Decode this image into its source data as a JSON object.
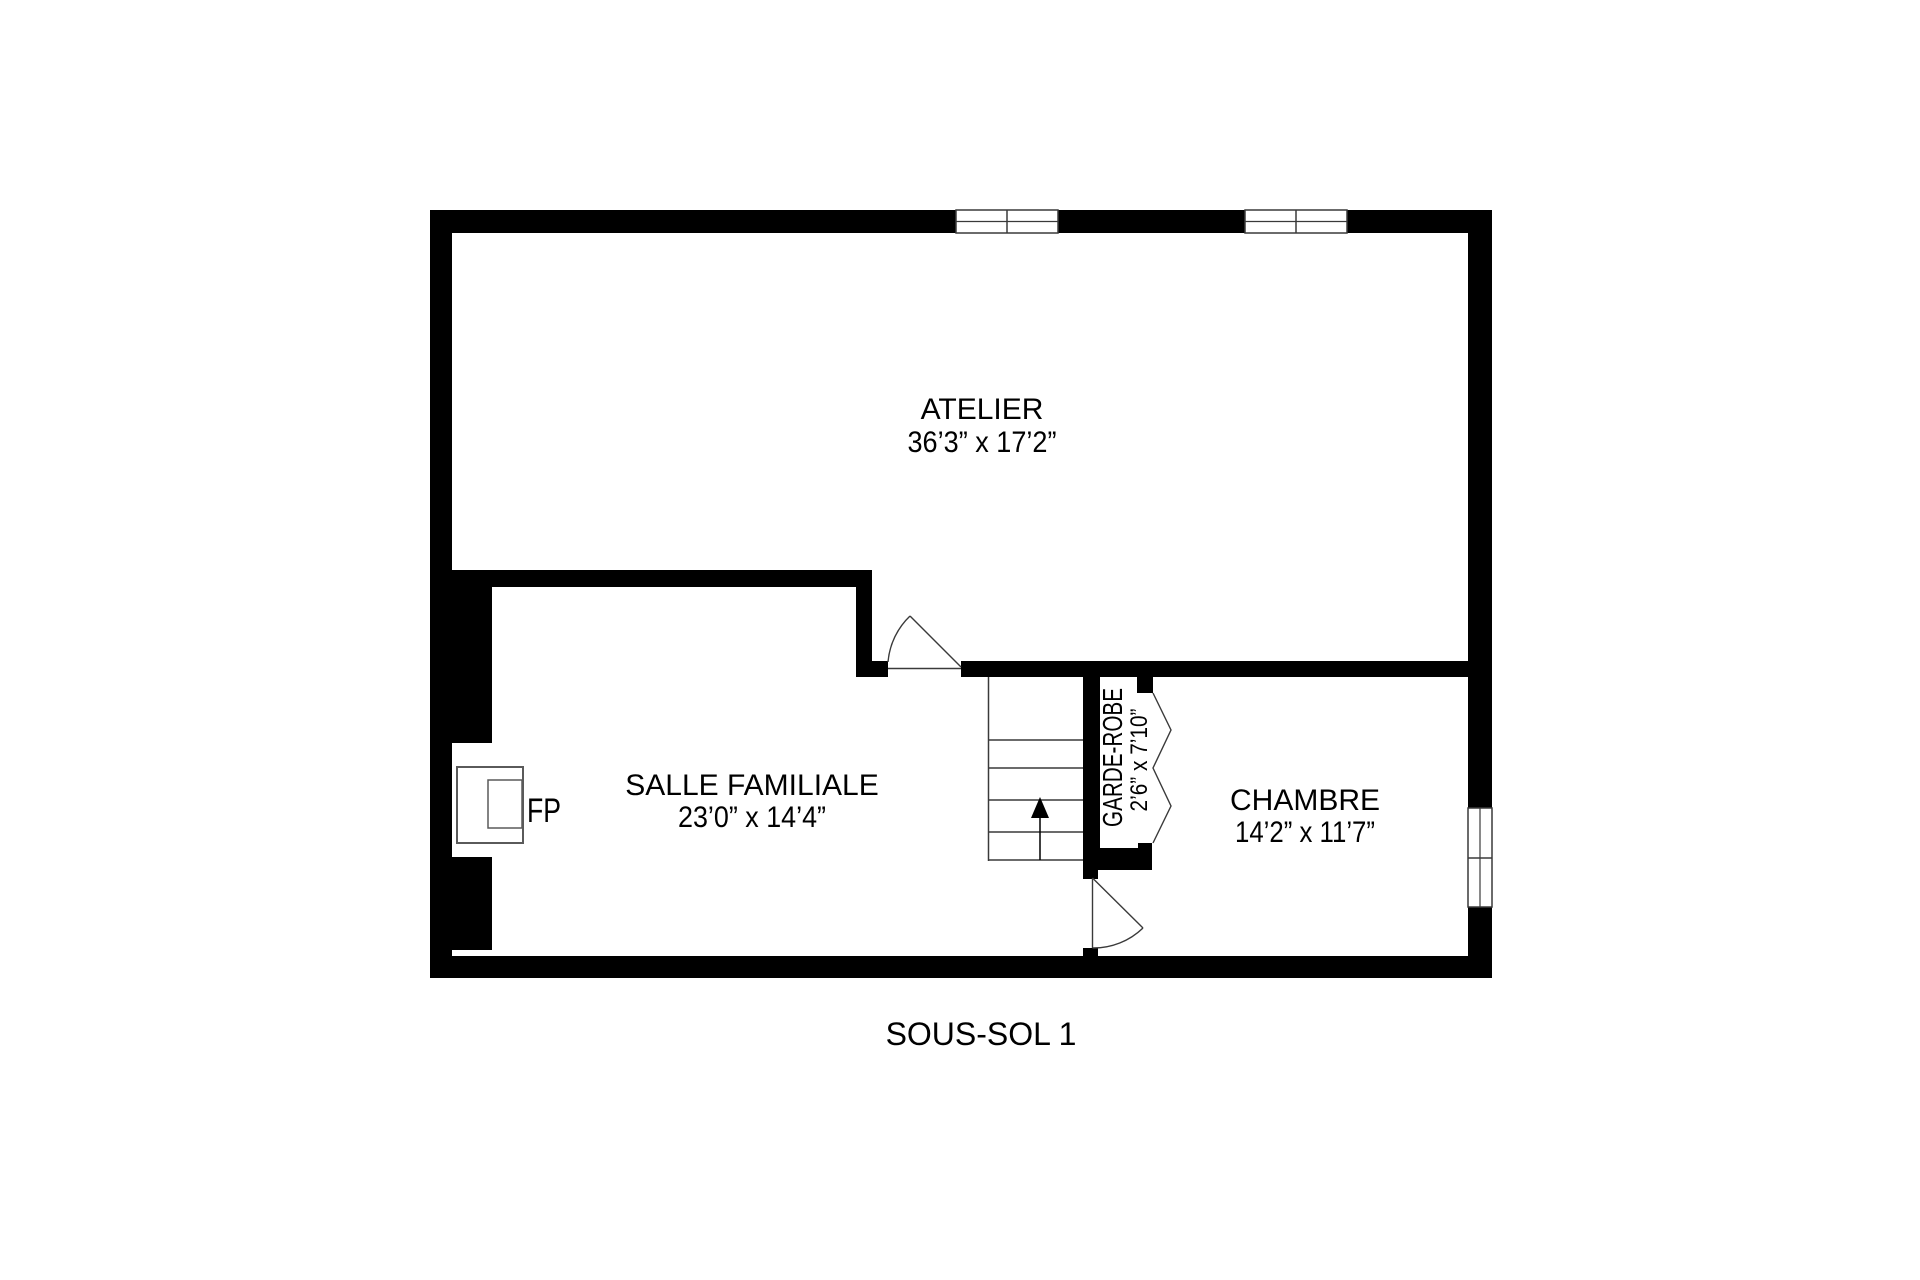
{
  "title": "SOUS-SOL 1",
  "rooms": {
    "atelier": {
      "name": "ATELIER",
      "dims": "36’3” x 17’2”"
    },
    "salle_familiale": {
      "name": "SALLE FAMILIALE",
      "dims": "23’0” x 14’4”"
    },
    "chambre": {
      "name": "CHAMBRE",
      "dims": "14’2” x 11’7”"
    },
    "garde_robe": {
      "name": "GARDE-ROBE",
      "dims": "2’6” x 7’10”"
    }
  },
  "fireplace": {
    "label": "FP"
  },
  "symbols": {
    "stairs_direction": "up-arrow",
    "doors": [
      "swing-door-atelier",
      "swing-door-chambre"
    ],
    "closet_door": "bifold-accordion",
    "windows": [
      "top-window-left",
      "top-window-right",
      "right-wall-window"
    ]
  },
  "colors": {
    "wall": "#000000",
    "line": "#3a3a3a",
    "fixture_line": "#5a5a5a",
    "background": "#ffffff"
  }
}
